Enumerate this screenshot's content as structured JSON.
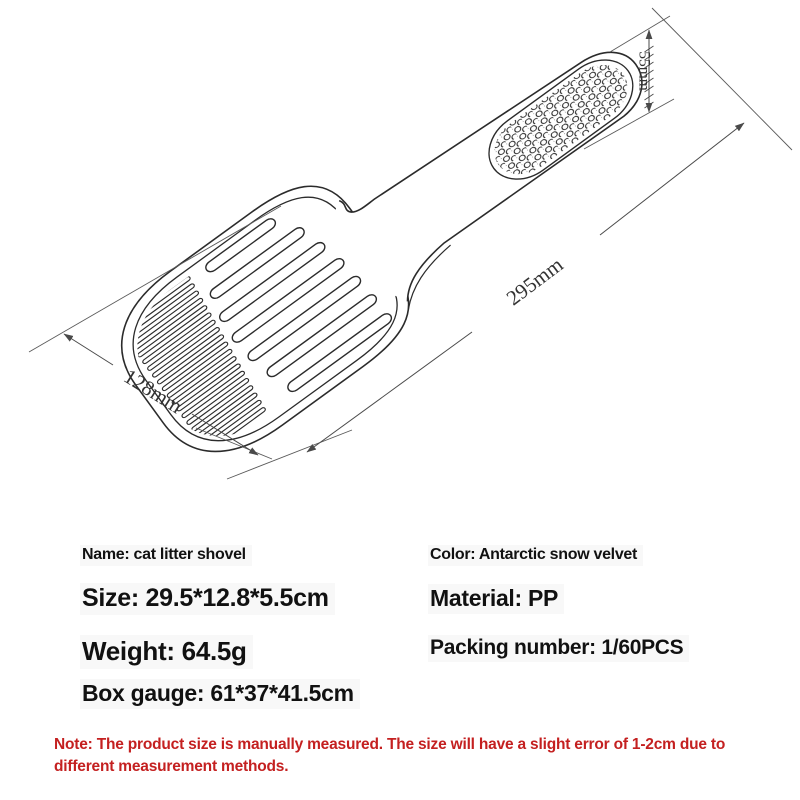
{
  "drawing": {
    "description": "isometric line drawing of cat litter shovel",
    "dimension_labels": {
      "handle_width": "55mm",
      "length": "295mm",
      "scoop_width": "128mm"
    }
  },
  "specs": {
    "name": "Name: cat litter shovel",
    "size": "Size: 29.5*12.8*5.5cm",
    "weight": "Weight: 64.5g",
    "box_gauge": "Box gauge: 61*37*41.5cm",
    "color": "Color: Antarctic snow velvet",
    "material": "Material: PP",
    "packing_number": "Packing number: 1/60PCS"
  },
  "note": {
    "text": "Note: The product size is manually measured. The size will have a slight error of 1-2cm due to different measurement methods."
  },
  "colors": {
    "line": "#2b2b2b",
    "dimension_line": "#4a4a4a",
    "note_red": "#c42020",
    "text": "#111111",
    "background": "#ffffff"
  }
}
